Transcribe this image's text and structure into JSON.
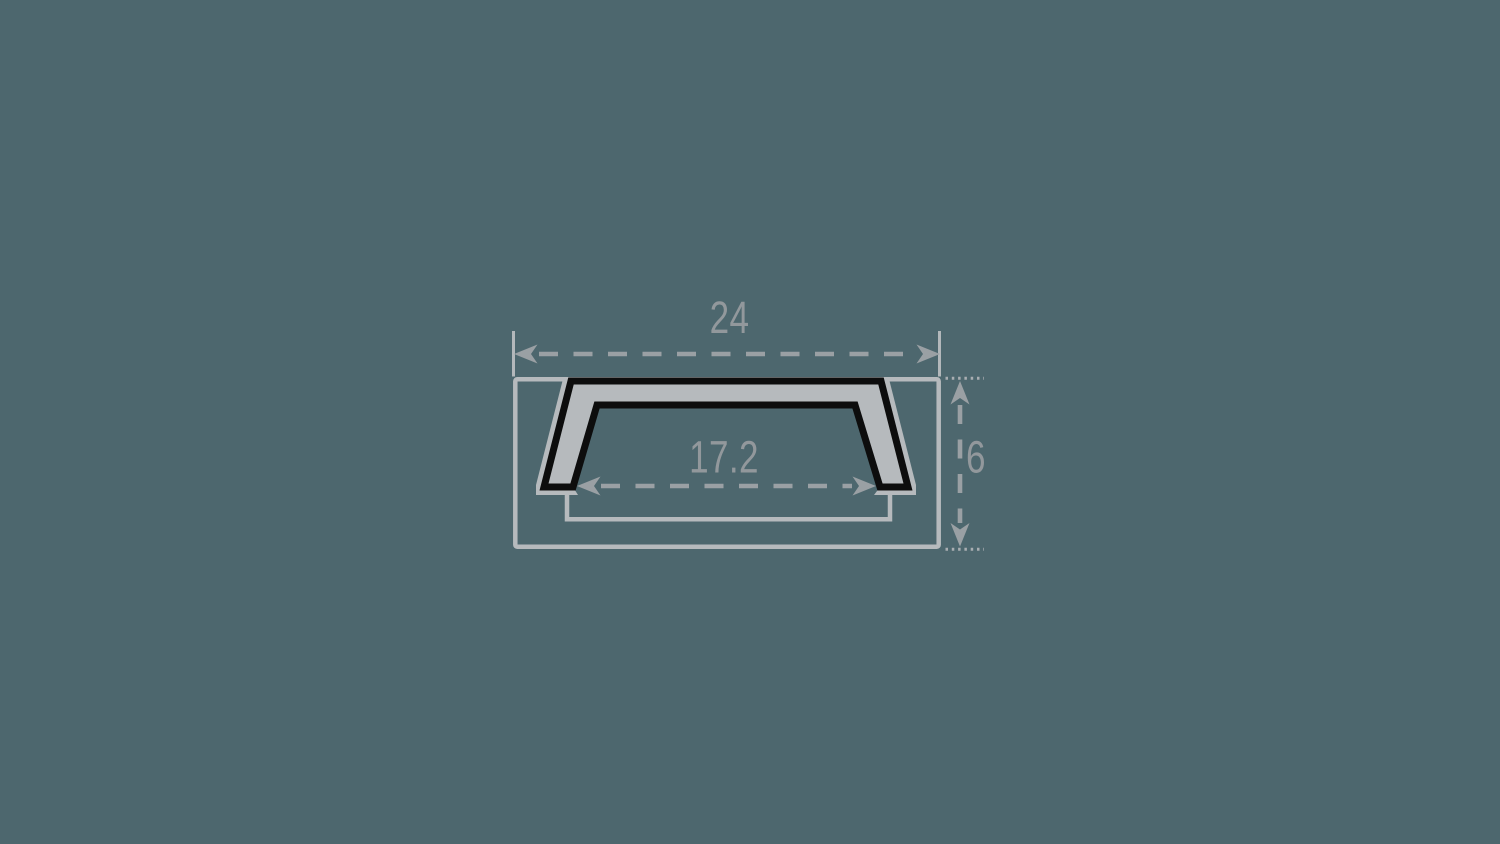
{
  "canvas": {
    "width": 1500,
    "height": 844
  },
  "drawing": {
    "type": "technical-cross-section",
    "subject": "recessed-led-profile-cross-section"
  },
  "dimensions": {
    "outer_width": {
      "label": "24"
    },
    "inner_width": {
      "label": "17.2"
    },
    "height": {
      "label": "6"
    }
  },
  "colors": {
    "background": "#4d676e",
    "profile_fill": "#b6babd",
    "profile_outline": "#0d0d0d",
    "recess_outline": "#b6babd",
    "dimension_lines": "#9aa0a4",
    "label_text": "#92989c"
  }
}
